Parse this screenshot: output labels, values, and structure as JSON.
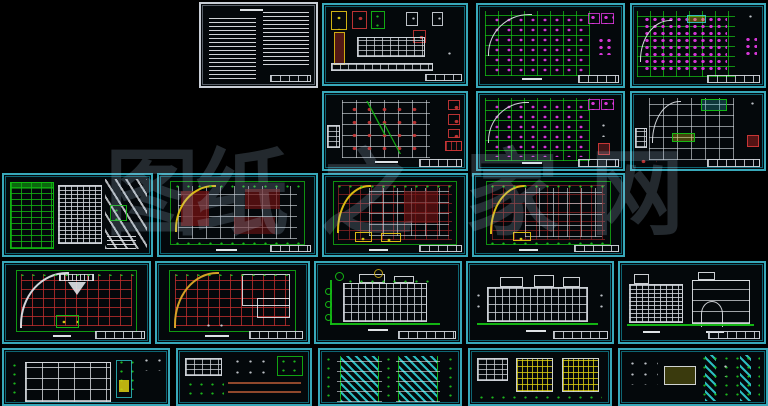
{
  "watermark": {
    "glyphs": [
      "图",
      "纸",
      "之",
      "家",
      "网"
    ],
    "color": "#aecde8"
  },
  "palette": {
    "background": "#000000",
    "panel_frame": "#38a8b9",
    "panel_frame_inner": "#0e6573",
    "spec_sheet_frame": "#c9ced6",
    "cad_green": "#14be14",
    "cad_red": "#c23030",
    "cad_dark_red_fill": "#6e1212",
    "cad_magenta": "#e23ae2",
    "cad_yellow": "#ddd012",
    "cad_white": "#d3d8dd",
    "cad_cyan": "#2ec6c9"
  },
  "sheets": [
    {
      "name": "general-notes",
      "kind": "text-specification"
    },
    {
      "name": "detail-and-schedule-sheet",
      "kind": "details-table"
    },
    {
      "name": "structural-plan-a",
      "kind": "structural-plan"
    },
    {
      "name": "structural-plan-b",
      "kind": "structural-plan"
    },
    {
      "name": "foundation-plan",
      "kind": "structural-plan"
    },
    {
      "name": "structural-plan-c",
      "kind": "structural-plan"
    },
    {
      "name": "roof-framing-plan",
      "kind": "structural-plan"
    },
    {
      "name": "site-plan-and-schedules",
      "kind": "site-plan"
    },
    {
      "name": "floor-plan-1",
      "kind": "floor-plan"
    },
    {
      "name": "floor-plan-2",
      "kind": "floor-plan"
    },
    {
      "name": "floor-plan-3",
      "kind": "floor-plan"
    },
    {
      "name": "roof-plan-a",
      "kind": "roof-plan"
    },
    {
      "name": "roof-plan-b",
      "kind": "roof-plan"
    },
    {
      "name": "elevation-a",
      "kind": "elevation"
    },
    {
      "name": "elevation-b",
      "kind": "elevation"
    },
    {
      "name": "elevation-and-section",
      "kind": "elevation"
    },
    {
      "name": "building-section",
      "kind": "section"
    },
    {
      "name": "construction-details",
      "kind": "details"
    },
    {
      "name": "stair-sections",
      "kind": "details"
    },
    {
      "name": "window-details",
      "kind": "details"
    },
    {
      "name": "node-details",
      "kind": "details"
    }
  ]
}
